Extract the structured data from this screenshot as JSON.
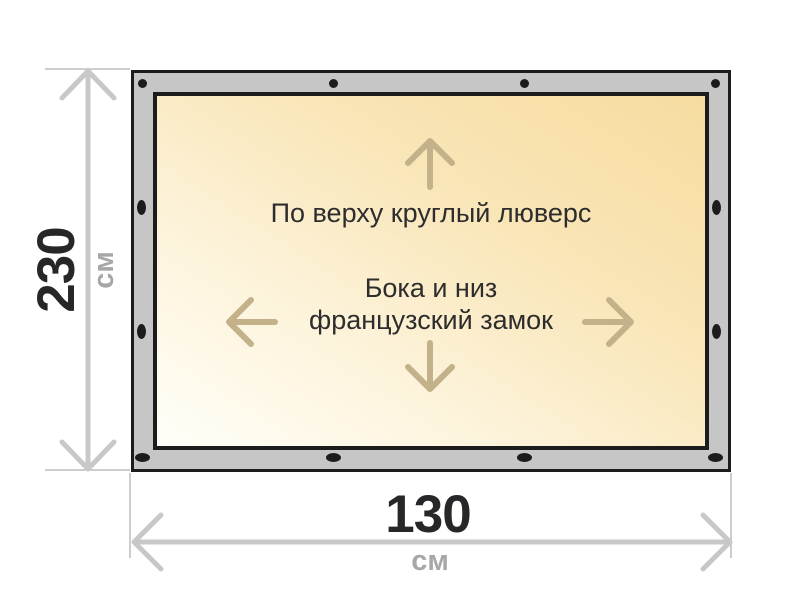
{
  "diagram": {
    "type": "tarpaulin-dimension-drawing",
    "notes": {
      "top": "По верху круглый люверс",
      "side_line1": "Бока и низ",
      "side_line2": "французский замок"
    },
    "dimensions": {
      "height": {
        "value": "230",
        "unit": "см"
      },
      "width": {
        "value": "130",
        "unit": "см"
      }
    },
    "grommets": {
      "top_count": 4,
      "bottom_count": 4,
      "left_count": 2,
      "right_count": 2
    },
    "colors": {
      "frame_gray": "#c5c6c5",
      "outline_black": "#1c1c1c",
      "canvas_gradient_start": "#f6dca0",
      "canvas_gradient_end": "#fffef8",
      "arrow_tan": "#c3b18a",
      "dimension_gray": "#c8c8c8",
      "value_text": "#27272a",
      "unit_text": "#a7a7a7",
      "note_text": "#2d2d2d"
    }
  }
}
